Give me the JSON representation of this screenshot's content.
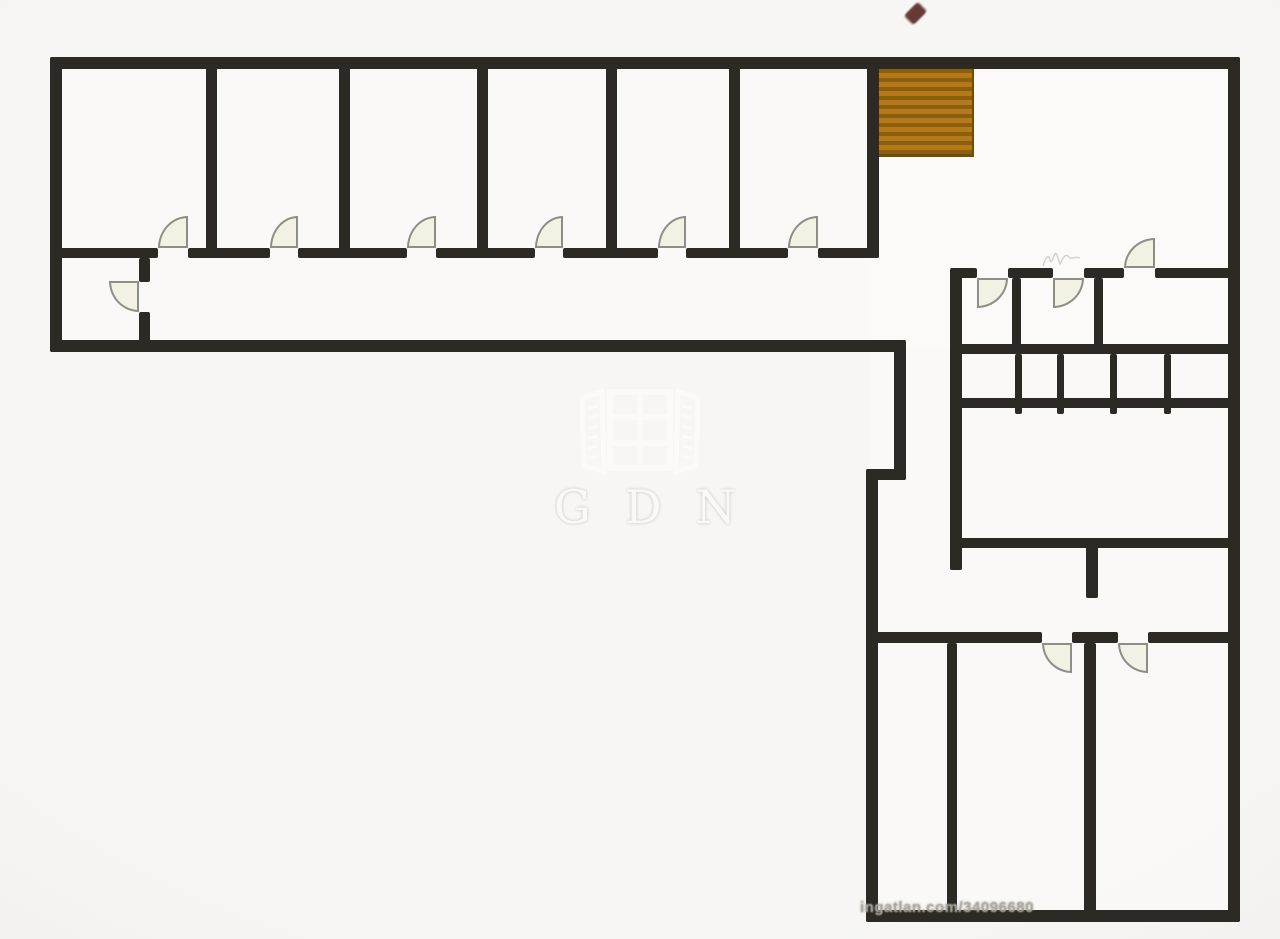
{
  "page": {
    "type": "apartment-floor-plan"
  },
  "branding": {
    "center_watermark": "GDN",
    "bottom_watermark": "ingatlan.com/34096680"
  },
  "icons": {
    "entrance_marker": "map-pin-diamond",
    "staircase": "stairs-treads",
    "center_logo": "open-window-icon"
  },
  "plan": {
    "top_room_count": 6,
    "door_arc_count": 12,
    "staircase_present": true,
    "stair_tread_count": 10
  },
  "colors": {
    "wall": "#2d2925",
    "stair": "#b5791c",
    "stair-stripe": "#8a5f0e",
    "stair-border": "#6e4c0a",
    "door-fill": "#f3f1e3",
    "door-stroke": "#8e8e86",
    "marker": "#5a2b27",
    "watermark": "#fbfaf9",
    "watermark-shadow": "#b9b5ae",
    "bottom-text": "#a9a49c"
  }
}
